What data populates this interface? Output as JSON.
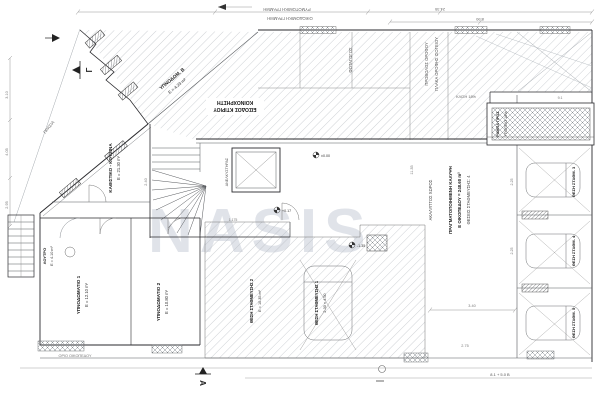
{
  "watermark": {
    "text": "NASIS"
  },
  "markers": {
    "gamma": "Γ",
    "a": "A"
  },
  "boundary": {
    "top_outer": "ΡΥΜΟΤΟΜΙΚΗ ΓΡΑΜΜΗ",
    "top_inner": "ΟΙΚΟΔΟΜΙΚΗ ΓΡΑΜΜΗ",
    "prasia": "ΠΡΑΣΙΑ",
    "plot_edge": "ΟΡΙΟ ΟΙΚΟΠΕΔΟΥ"
  },
  "notice": {
    "line1": "ΚΟΙΝΟΧΡΗΣΤΗ",
    "line2": "ΕΙΣΟΔΟΣ ΚΤΙΡΙΟΥ"
  },
  "rooms": [
    {
      "name": "ΥΠΝΟΔΩΜ. Β",
      "area": "E = 4.23 m²"
    },
    {
      "name": "ΚΑΘΙΣΤΙΚΟ - ΚΟΥΖΙΝΑ",
      "area": "E = 21.30 m²"
    },
    {
      "name": "ΥΠΝΟΔΩΜΑΤΙΟ 1",
      "area": "E = 12.10 m²"
    },
    {
      "name": "ΥΠΝΟΔΩΜΑΤΙΟ 2",
      "area": "E = 10.80 m²"
    },
    {
      "name": "ΛΟΥΤΡΟ",
      "area": "E = 4.10 m²"
    }
  ],
  "core": {
    "elevator": "ΑΝΕΛΚΥΣΤΗΡΑΣ"
  },
  "band_labels": [
    "ΠΡΟΒΟΛΟΣ ΟΡΟΦΟΥ",
    "ΠΛΑΚΑ ΟΡΟΦΗΣ ΙΣΟΓΕΙΟΥ",
    "ΦΩΤΑΓΩΓΟΣ"
  ],
  "annotation_block": {
    "line1": "ΑΚΑΛΥΠΤΟΣ ΧΩΡΟΣ",
    "line2": "ΠΡΑΓΜΑΤΟΠΟΙΗΜΕΝΗ ΚΑΛΥΨΗ",
    "line3": "Ε ΟΙΚΟΠΕΔΟΥ = 248.60 m²",
    "line4": "ΘΕΣΕΙΣ ΣΤΑΘΜΕΥΣΗΣ: 4"
  },
  "ramp": {
    "label1": "ΡΑΜΠΑ ΠΡΟΣ",
    "label2": "ΥΠΟΓΕΙΟ 18%",
    "slope": "ΚΛΙΣΗ 18%"
  },
  "parking": {
    "stalls": [
      {
        "label": "ΘΕΣΗ ΣΤΑΘΜΕΥΣΗΣ 1",
        "size": "2.30 × 4.50"
      },
      {
        "label": "ΘΕΣΗ ΣΤΑΘΜΕΥΣΗΣ 2",
        "size": "E = 10.35 m²"
      },
      {
        "label": "ΘΕΣΗ ΣΤΑΘΜ. 3"
      },
      {
        "label": "ΘΕΣΗ ΣΤΑΘΜ. 4"
      },
      {
        "label": "ΘΕΣΗ ΣΤΑΘΜ. 5"
      }
    ]
  },
  "levels": [
    "±0.00",
    "+0.17",
    "-1.35"
  ],
  "dims": {
    "top": "24.35",
    "top2": "8.90",
    "left1": "3.10",
    "left2": "4.05",
    "left3": "2.95",
    "bottom": "8.1 + 5.0 Β",
    "bottom2": "2.75",
    "bottom3": "3.40",
    "stall1": "2.25",
    "stall2": "2.25",
    "d1": "2.40",
    "d2": "1.175",
    "d3": "11.35",
    "d4": "9.1"
  }
}
